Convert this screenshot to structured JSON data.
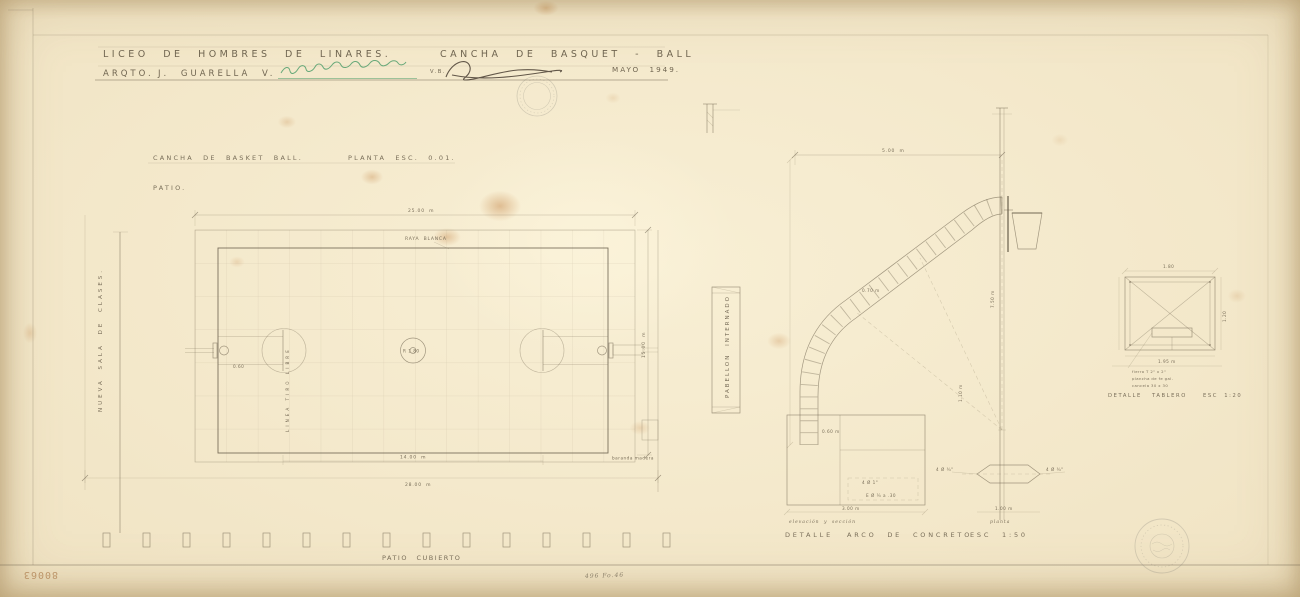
{
  "sheet": {
    "archive_number": "80063",
    "reference_note": "496 Fo.46"
  },
  "title_block": {
    "project_title": "LICEO  DE  HOMBRES  DE  LINARES.",
    "drawing_title": "CANCHA  DE  BASQUET - BALL",
    "architect_label": "ARQTO.",
    "architect_name": "J. GUARELLA  V.",
    "visa_label": "V.B.",
    "date": "MAYO 1949."
  },
  "plan": {
    "caption": "CANCHA  DE  BASKET  BALL.",
    "scale": "PLANTA  ESC. 0.01.",
    "patio_label": "PATIO.",
    "left_wing_label": "NUEVA  SALA  DE  CLASES.",
    "covered_patio_label": "PATIO  CUBIERTO",
    "white_line_note": "RAYA BLANCA",
    "free_throw_note": "LINEA  TIRO  LIBRE",
    "corner_note": "baranda madera",
    "center_radius": "R 1.80",
    "hoop_offset": "0.60",
    "dim_top": "25.00 m",
    "dim_right": "15.00 m",
    "dim_bottom_inner": "14.00 m",
    "dim_bottom_outer": "28.00 m"
  },
  "arch_detail": {
    "pavilion_label": "PABELLON  INTERNADO",
    "dim_span": "5.00 m",
    "dim_band": "0.70 m",
    "dim_height": "7.50 m",
    "dim_base": "1.10 m",
    "dim_depth": "0.60 m",
    "rebar_main": "4 Ø 1\"",
    "rebar_stirrups": "E Ø ¼ a .30",
    "dim_footing": "3.00 m",
    "plate_rebar_left": "4 Ø ¾\"",
    "plate_rebar_right": "4 Ø ¾\"",
    "dim_plate": "1.00 m",
    "elevation_label": "elevación y sección",
    "plan_label": "planta",
    "caption_label": "DETALLE",
    "caption_subject": "ARCO  DE  CONCRETO",
    "caption_scale": "ESC  1:50"
  },
  "board_detail": {
    "dim_top": "1.80",
    "dim_right": "1.20",
    "dim_bottom": "1.95 m",
    "note_1": "fierro T 2\" x 2\"",
    "note_2": "plancha de fe gal.",
    "note_3": "cancela 30 x 30",
    "caption_label": "DETALLE",
    "caption_subject": "TABLERO",
    "caption_scale": "ESC  1:20"
  }
}
